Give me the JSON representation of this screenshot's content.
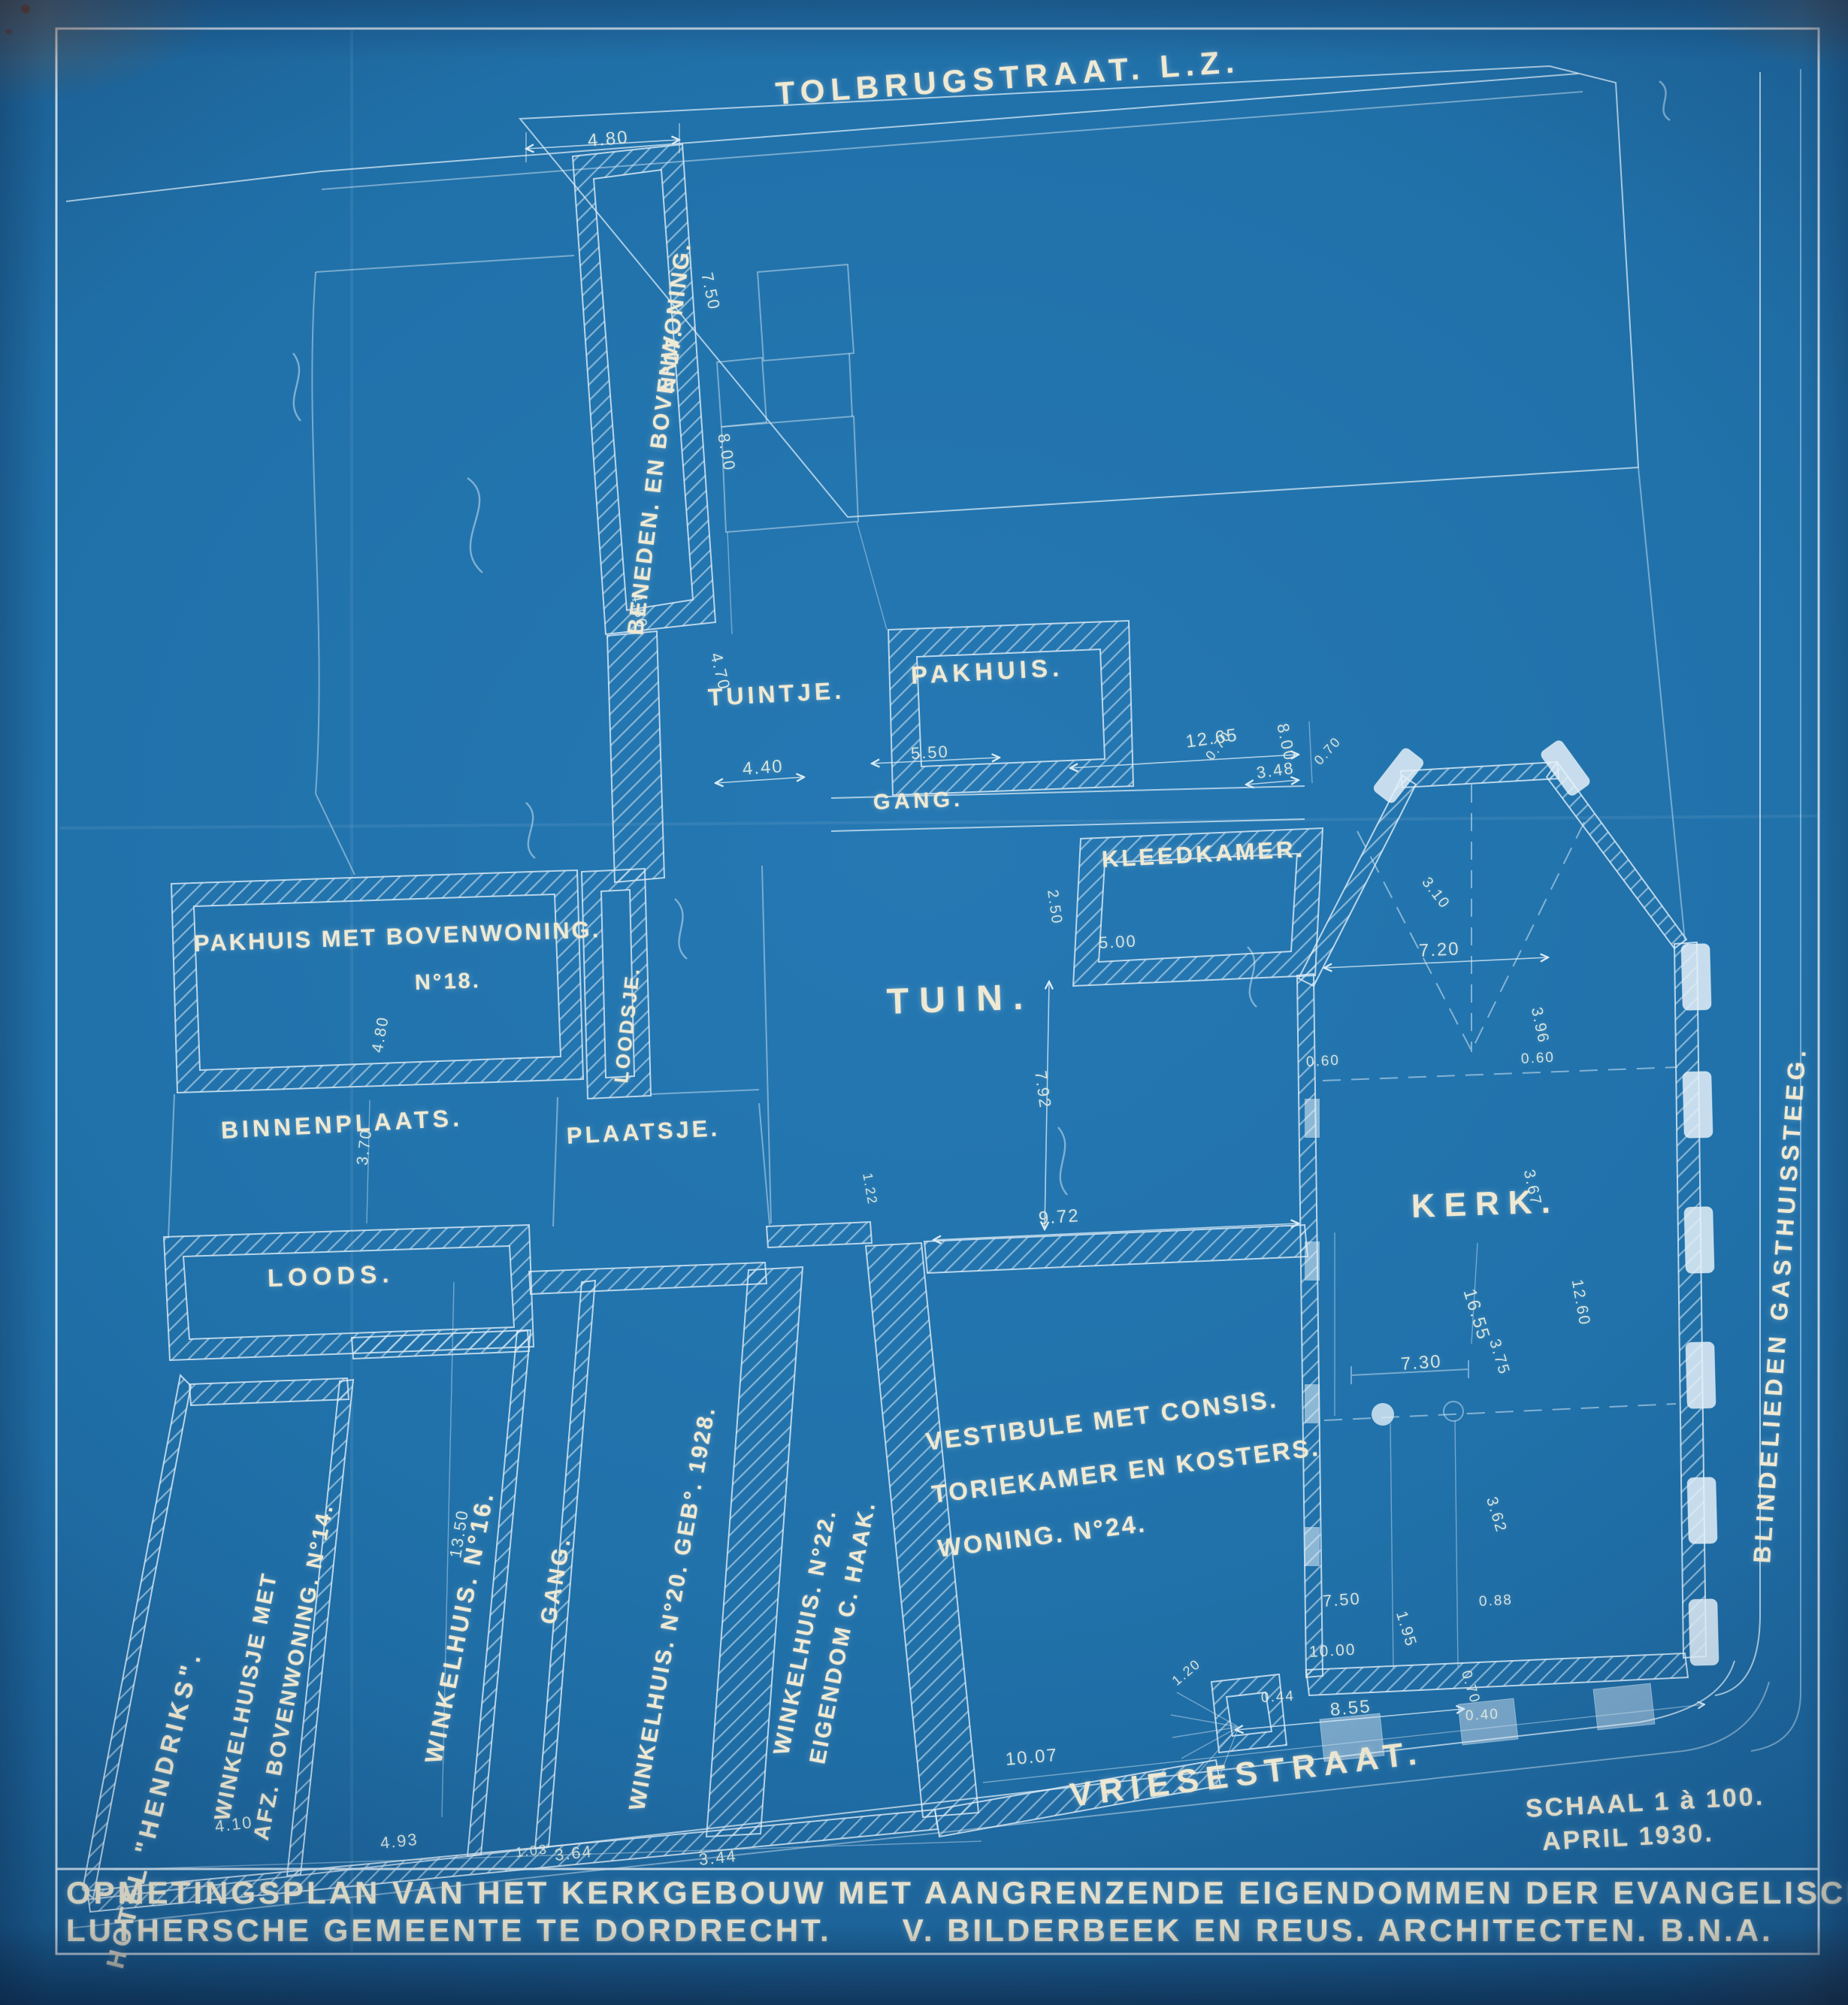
{
  "document": {
    "type": "cyanotype blueprint site survey plan",
    "colors": {
      "paper": "#1f6ca5",
      "linework": "#d7e8f3",
      "lettering": "#efe9d3"
    }
  },
  "title_block": {
    "line1": "OPMETINGSPLAN VAN HET KERKGEBOUW MET AANGRENZENDE EIGENDOMMEN DER EVANGELISCH",
    "line2": "LUTHERSCHE GEMEENTE TE DORDRECHT.      V. BILDERBEEK EN REUS. ARCHITECTEN. B.N.A."
  },
  "scale_note": {
    "scale": "SCHAAL 1 à 100.",
    "date": "APRIL 1930."
  },
  "labels": {
    "street_top": "TOLBRUGSTRAAT. L.Z.",
    "street_bottom": "VRIESESTRAAT.",
    "street_right": "BLINDELIEDEN GASTHUISSTEEG.",
    "hotel": "HOTEL \"HENDRIKS\".",
    "n17_main": "BENEDEN. EN BOVENWONING.",
    "n17_no": "N°17.",
    "tuintje": "TUINTJE.",
    "pakhuis": "PAKHUIS.",
    "gang_top": "GANG.",
    "kleedkamer": "KLEEDKAMER.",
    "n18_main": "PAKHUIS MET BOVENWONING.",
    "n18_no": "N°18.",
    "loodsje": "LOODSJE.",
    "tuin": "TUIN.",
    "binnenplaats": "BINNENPLAATS.",
    "plaatsje": "PLAATSJE.",
    "loods": "LOODS.",
    "kerk": "KERK.",
    "n14_l1": "WINKELHUISJE MET",
    "n14_l2": "AFZ. BOVENWONING. N°14.",
    "n16": "WINKELHUIS. N°16.",
    "gang_shops": "GANG.",
    "n20": "WINKELHUIS. N°20. GEB°. 1928.",
    "n22": "WINKELHUIS. N°22.",
    "n22_owner": "EIGENDOM C. HAAK.",
    "vest_l1": "VESTIBULE MET CONSIS.",
    "vest_l2": "TORIEKAMER EN KOSTERS.",
    "vest_l3": "WONING. N°24."
  },
  "dims": {
    "d480a": "4.80",
    "d750a": "7.50",
    "d800a": "8.00",
    "d450": "4.50",
    "d470": "4.70",
    "d440": "4.40",
    "d550": "5.50",
    "d1265": "12.65",
    "d348": "3.48",
    "d800b": "8.00",
    "d070a": "0.70",
    "d070b": "0.70",
    "d310": "3.10",
    "d250": "2.50",
    "d500": "5.00",
    "d720": "7.20",
    "d060a": "0.60",
    "d060b": "0.60",
    "d396": "3.96",
    "d367": "3.67",
    "d1260": "12.60",
    "d792": "7.92",
    "d972": "9.72",
    "d122": "1.22",
    "d1655": "16.55",
    "d375": "3.75",
    "d730": "7.30",
    "d362": "3.62",
    "d750b": "7.50",
    "d195": "1.95",
    "d1000": "10.00",
    "d088": "0.88",
    "d044": "0.44",
    "d855": "8.55",
    "d040": "0.40",
    "d070c": "0.70",
    "d120": "1.20",
    "d1007": "10.07",
    "d1350": "13.50",
    "d370": "3.70",
    "d480b": "4.80",
    "d410": "4.10",
    "d493": "4.93",
    "d103": "1.03",
    "d364": "3.64",
    "d344": "3.44"
  }
}
